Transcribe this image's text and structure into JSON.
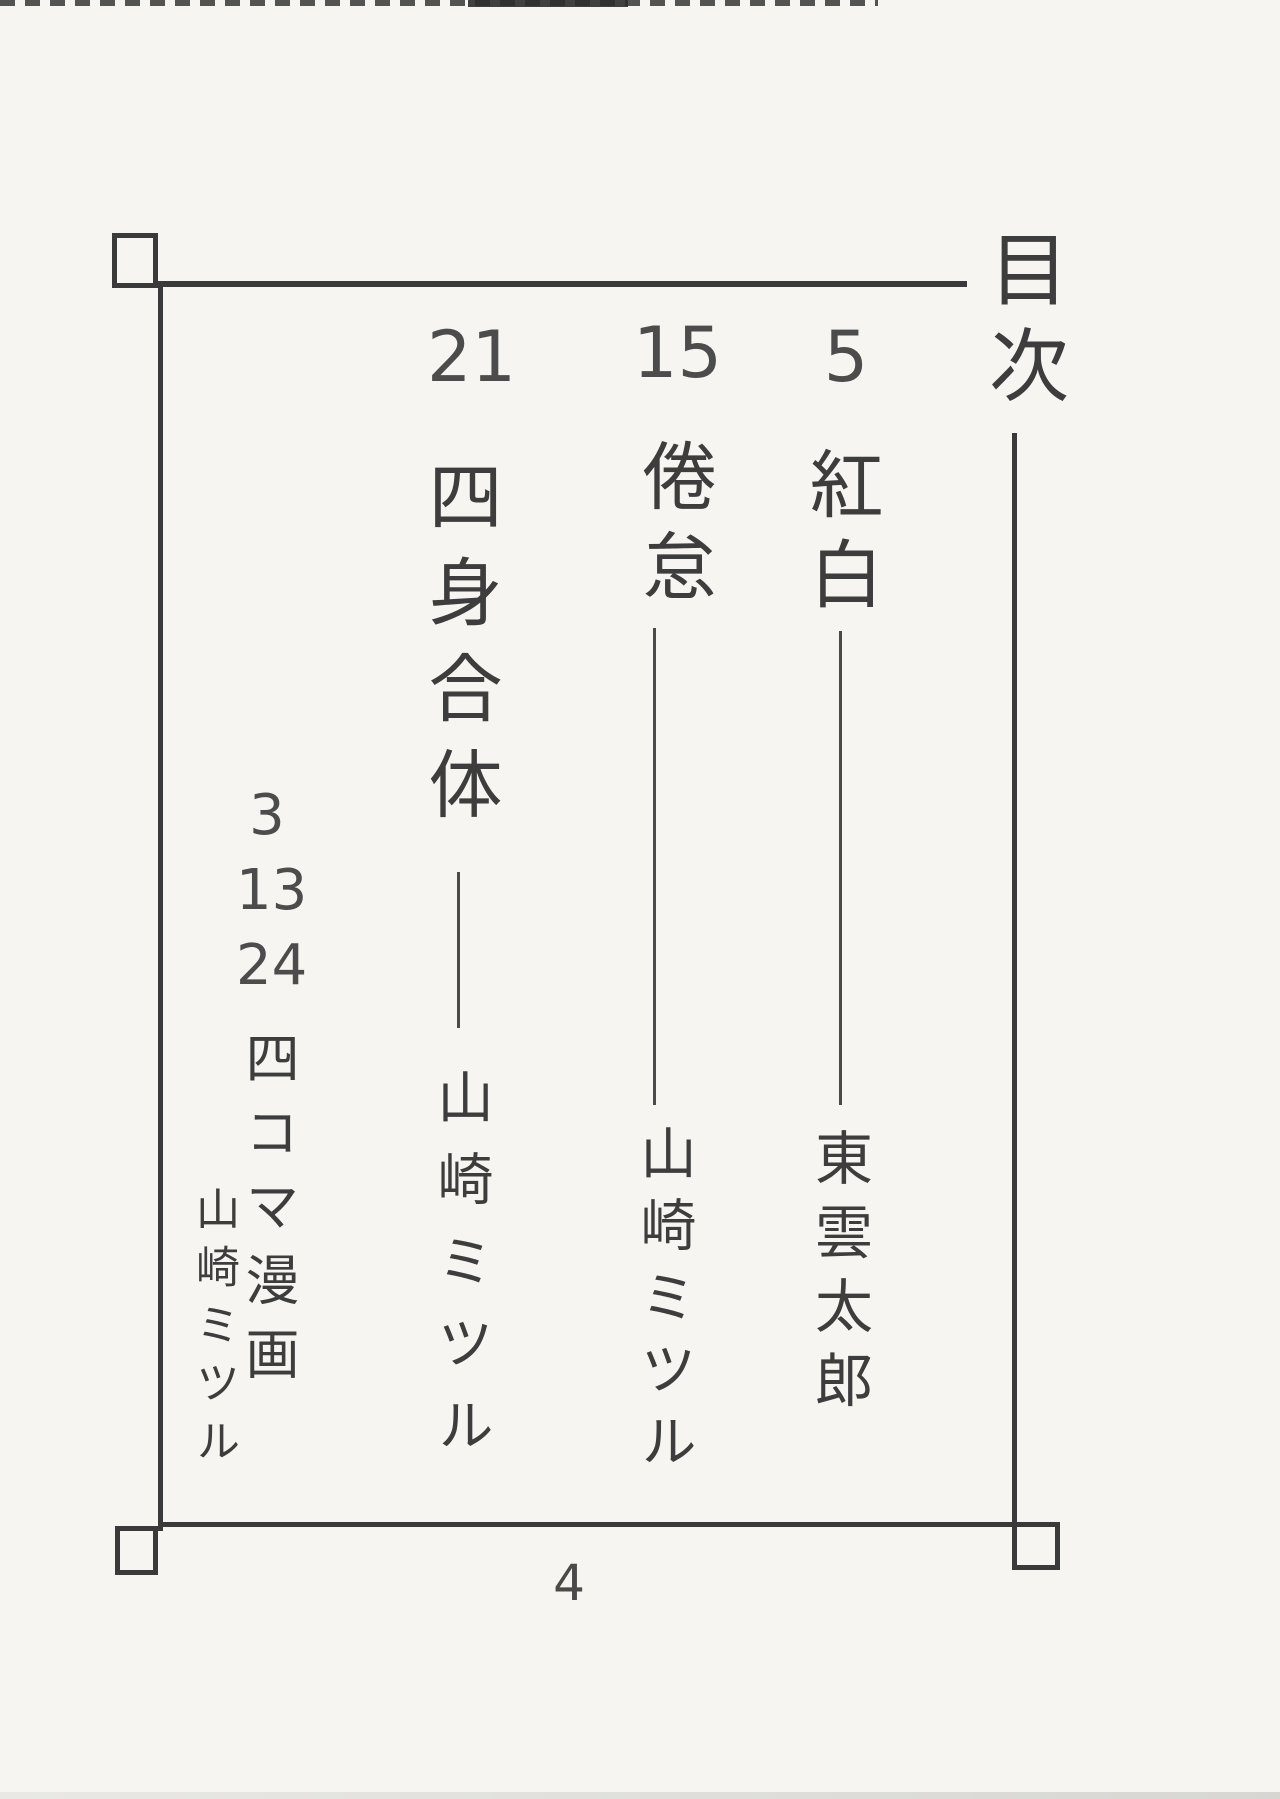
{
  "colors": {
    "paper": "#f6f5f1",
    "ink": "#3d3d3d"
  },
  "header": {
    "title": "目次"
  },
  "entries": [
    {
      "title": "紅白",
      "author": "東雲太郎",
      "page": "5"
    },
    {
      "title": "倦怠",
      "author": "山崎ミツル",
      "page": "15"
    },
    {
      "title": "四身合体",
      "author": "山崎ミツル",
      "page": "21"
    },
    {
      "title": "四コマ漫画",
      "author": "山崎ミツル",
      "pages": [
        "3",
        "13",
        "24"
      ]
    }
  ],
  "folio": "4"
}
